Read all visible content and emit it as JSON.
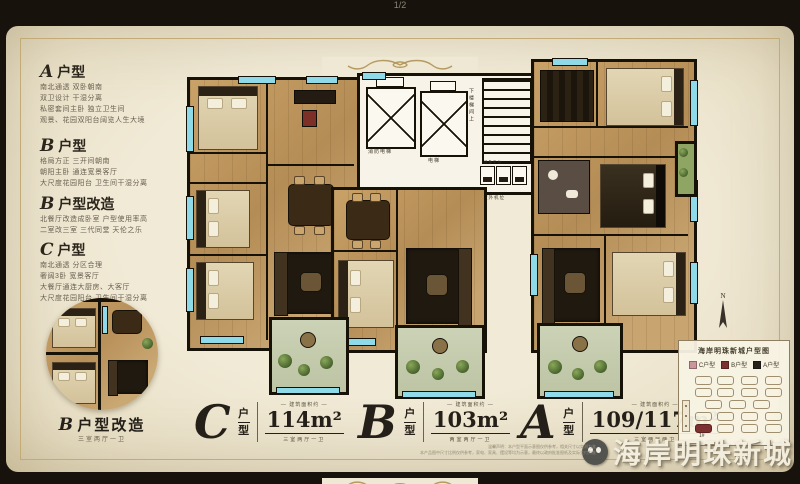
{
  "page": {
    "indicator": "1/2"
  },
  "left_panel": {
    "sections": [
      {
        "letter": "A",
        "title": "户型",
        "lines": [
          "南北通透 双卧朝南",
          "双卫设计 干湿分离",
          "私密套间主卧 独立卫生间",
          "观景、花园双阳台阔览人生大境"
        ]
      },
      {
        "letter": "B",
        "title": "户型",
        "lines": [
          "格局方正 三开间朝南",
          "朝阳主卧 通连宽景客厅",
          "大尺度花园阳台 卫生间干湿分离"
        ]
      },
      {
        "letter": "B",
        "title": "户型改造",
        "lines": [
          "北餐厅改造成卧室 户型使用率高",
          "二室改三室 三代同堂 天伦之乐"
        ]
      },
      {
        "letter": "C",
        "title": "户型",
        "lines": [
          "南北通透 分区合理",
          "奢阔3卧 宽景客厅",
          "大餐厅通连大厨房、大客厅",
          "大尺度花园阳台 卫生间干湿分离"
        ]
      }
    ]
  },
  "inset": {
    "letter": "B",
    "title": "户型改造",
    "subtitle": "三室两厅一卫"
  },
  "plan": {
    "fire_elevator": "消防电梯",
    "elevator": "电梯",
    "stair_down": "下",
    "stairwell": "楼梯间",
    "stair_up": "上",
    "equipment": "设备平台",
    "outdoor_unit": "室外机位"
  },
  "units": [
    {
      "letter": "C",
      "hu": "户",
      "xing": "型",
      "area_note": "— 建筑面积约 —",
      "area": "114m²",
      "rooms": "三室两厅一卫"
    },
    {
      "letter": "B",
      "hu": "户",
      "xing": "型",
      "area_note": "— 建筑面积约 —",
      "area": "103m²",
      "rooms": "两室两厅一卫"
    },
    {
      "letter": "A",
      "hu": "户",
      "xing": "型",
      "area_note": "— 建筑面积约 —",
      "area": "109/117m²",
      "rooms": "三室两厅两卫"
    }
  ],
  "compass": {
    "letter": "N"
  },
  "legend": {
    "title": "海岸明珠新城户型图",
    "items": [
      {
        "label": "C户型",
        "color": "#c9969b"
      },
      {
        "label": "B户型",
        "color": "#7c3030"
      },
      {
        "label": "A户型",
        "color": "#26211b"
      }
    ],
    "building_label": "1#"
  },
  "watermark": {
    "text": "海岸明珠新城"
  },
  "disclaimer": {
    "line1": "温馨声明：本户型平面示意图仅供参考，相关尺寸以实测为准",
    "line2": "本产品图中尺寸比例仅供参考，家电、家具、摆设等均为示意，最终以政府批准图纸及实际交付为准"
  }
}
